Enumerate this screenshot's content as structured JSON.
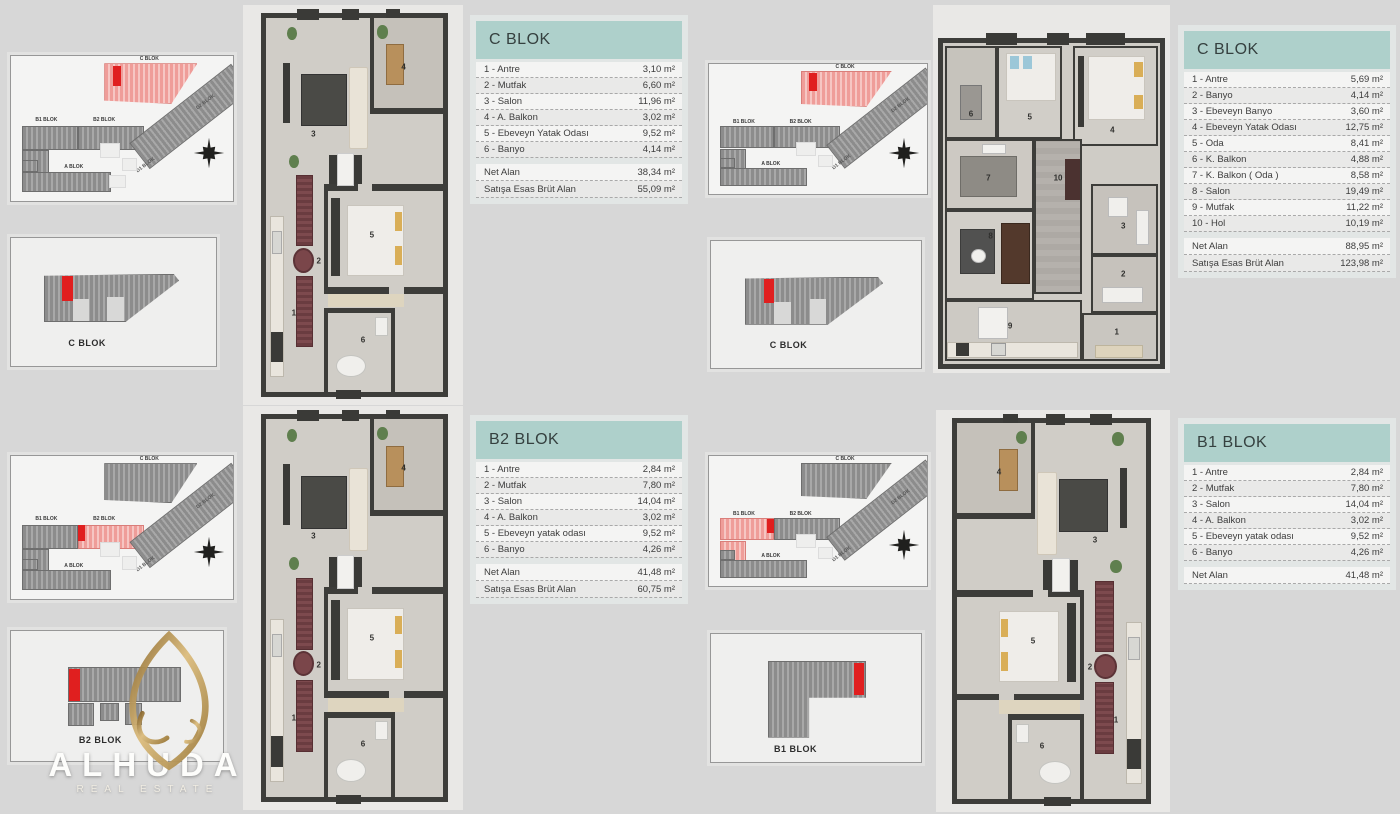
{
  "palette": {
    "accent_red": "#e01f1f",
    "highlight_pink": "#f2a7a4",
    "table_header_teal": "#aed0cb",
    "gold": "#bd9455",
    "wall": "#3d3d3a"
  },
  "logo": {
    "name": "ALHUDA",
    "tagline": "REAL ESTATE"
  },
  "site_plan": {
    "c_label": "C BLOK",
    "b1_label": "B1 BLOK",
    "b2_label": "B2 BLOK",
    "a_label": "A BLOK",
    "d1_label": "D1 BLOK",
    "d2_label": "D2 BLOK"
  },
  "detail_boxes": {
    "c_label": "C BLOK",
    "b2_label": "B2 BLOK",
    "b1_label": "B1 BLOK"
  },
  "tables": {
    "c_small": {
      "title": "C BLOK",
      "rows": [
        {
          "label": "1 - Antre",
          "value": "3,10 m²"
        },
        {
          "label": "2 - Mutfak",
          "value": "6,60 m²"
        },
        {
          "label": "3 - Salon",
          "value": "11,96 m²"
        },
        {
          "label": "4 - A. Balkon",
          "value": "3,02 m²"
        },
        {
          "label": "5 - Ebeveyn Yatak Odası",
          "value": "9,52 m²"
        },
        {
          "label": "6 - Banyo",
          "value": "4,14 m²"
        }
      ],
      "summary": [
        {
          "label": "Net Alan",
          "value": "38,34 m²"
        },
        {
          "label": "Satışa Esas Brüt Alan",
          "value": "55,09 m²"
        }
      ]
    },
    "c_large": {
      "title": "C BLOK",
      "rows": [
        {
          "label": "1 - Antre",
          "value": "5,69 m²"
        },
        {
          "label": "2 - Banyo",
          "value": "4,14 m²"
        },
        {
          "label": "3 - Ebeveyn Banyo",
          "value": "3,60 m²"
        },
        {
          "label": "4 - Ebeveyn Yatak Odası",
          "value": "12,75 m²"
        },
        {
          "label": "5 - Oda",
          "value": "8,41 m²"
        },
        {
          "label": "6 - K. Balkon",
          "value": "4,88 m²"
        },
        {
          "label": "7 - K. Balkon ( Oda )",
          "value": "8,58 m²"
        },
        {
          "label": "8 - Salon",
          "value": "19,49 m²"
        },
        {
          "label": "9 - Mutfak",
          "value": "11,22 m²"
        },
        {
          "label": "10 - Hol",
          "value": "10,19 m²"
        }
      ],
      "summary": [
        {
          "label": "Net Alan",
          "value": "88,95 m²"
        },
        {
          "label": "Satışa Esas Brüt Alan",
          "value": "123,98 m²"
        }
      ]
    },
    "b2": {
      "title": "B2 BLOK",
      "rows": [
        {
          "label": "1 - Antre",
          "value": "2,84 m²"
        },
        {
          "label": "2 - Mutfak",
          "value": "7,80 m²"
        },
        {
          "label": "3 - Salon",
          "value": "14,04 m²"
        },
        {
          "label": "4 - A. Balkon",
          "value": "3,02 m²"
        },
        {
          "label": "5 - Ebeveyn yatak odası",
          "value": "9,52 m²"
        },
        {
          "label": "6 - Banyo",
          "value": "4,26 m²"
        }
      ],
      "summary": [
        {
          "label": "Net Alan",
          "value": "41,48 m²"
        },
        {
          "label": "Satışa Esas Brüt Alan",
          "value": "60,75 m²"
        }
      ]
    },
    "b1": {
      "title": "B1 BLOK",
      "rows": [
        {
          "label": "1 - Antre",
          "value": "2,84 m²"
        },
        {
          "label": "2 - Mutfak",
          "value": "7,80 m²"
        },
        {
          "label": "3 - Salon",
          "value": "14,04 m²"
        },
        {
          "label": "4 - A. Balkon",
          "value": "3,02 m²"
        },
        {
          "label": "5 - Ebeveyn yatak odası",
          "value": "9,52 m²"
        },
        {
          "label": "6 - Banyo",
          "value": "4,26 m²"
        }
      ],
      "summary": [
        {
          "label": "Net Alan",
          "value": "41,48 m²"
        }
      ]
    }
  },
  "floorplans": {
    "c_small": {
      "rooms": [
        "1",
        "2",
        "3",
        "4",
        "5",
        "6"
      ]
    },
    "b2": {
      "rooms": [
        "1",
        "2",
        "3",
        "4",
        "5",
        "6"
      ]
    },
    "b1": {
      "rooms": [
        "1",
        "2",
        "3",
        "4",
        "5",
        "6"
      ]
    },
    "c_large": {
      "rooms": [
        "1",
        "2",
        "3",
        "4",
        "5",
        "6",
        "7",
        "8",
        "9",
        "10"
      ]
    }
  }
}
